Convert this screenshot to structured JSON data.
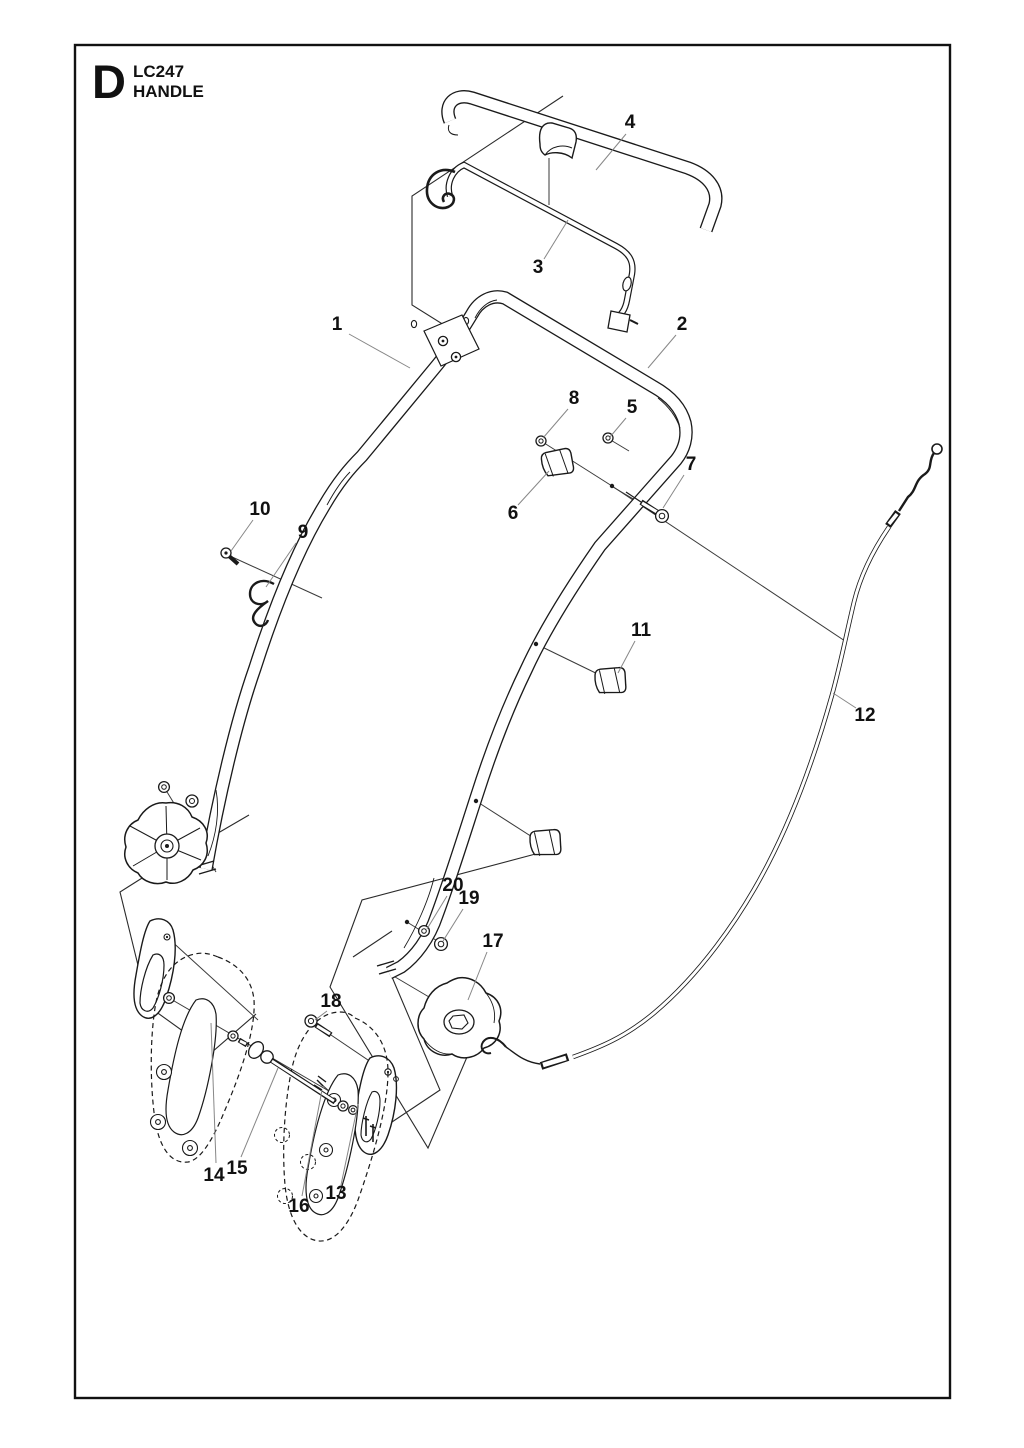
{
  "page": {
    "bg": "#ffffff",
    "ink": "#1a1a1a",
    "leader_color": "#878787",
    "axis_color": "#3a3a3a"
  },
  "title": {
    "section_letter": "D",
    "model": "LC247",
    "sheet_name": "HANDLE"
  },
  "parts_legend": {
    "1": "handle-upper",
    "2": "handle-lower",
    "3": "bail-rod",
    "4": "bail-handle",
    "5": "nut",
    "6": "cable-clamp",
    "7": "bolt",
    "8": "nut",
    "9": "cable-clip",
    "10": "screw",
    "11": "cable-clamp",
    "12": "cable",
    "13": "bracket-plate",
    "14": "handle-bracket-left",
    "15": "carriage-bolt",
    "16": "handle-bracket-right",
    "17": "knob",
    "18": "bolt",
    "19": "nut",
    "20": "washer"
  },
  "callouts": [
    {
      "n": "1",
      "x": 337,
      "y": 330,
      "lx1": 349,
      "ly1": 334,
      "lx2": 410,
      "ly2": 368
    },
    {
      "n": "2",
      "x": 682,
      "y": 330,
      "lx1": 676,
      "ly1": 335,
      "lx2": 648,
      "ly2": 368
    },
    {
      "n": "3",
      "x": 538,
      "y": 273,
      "lx1": 544,
      "ly1": 259,
      "lx2": 568,
      "ly2": 220
    },
    {
      "n": "4",
      "x": 630,
      "y": 128,
      "lx1": 626,
      "ly1": 134,
      "lx2": 596,
      "ly2": 170
    },
    {
      "n": "5",
      "x": 632,
      "y": 413,
      "lx1": 626,
      "ly1": 418,
      "lx2": 610,
      "ly2": 437
    },
    {
      "n": "6",
      "x": 513,
      "y": 519,
      "lx1": 518,
      "ly1": 505,
      "lx2": 549,
      "ly2": 471
    },
    {
      "n": "7",
      "x": 691,
      "y": 470,
      "lx1": 684,
      "ly1": 475,
      "lx2": 663,
      "ly2": 508
    },
    {
      "n": "8",
      "x": 574,
      "y": 404,
      "lx1": 568,
      "ly1": 409,
      "lx2": 543,
      "ly2": 438
    },
    {
      "n": "9",
      "x": 303,
      "y": 538,
      "lx1": 296,
      "ly1": 543,
      "lx2": 266,
      "ly2": 587
    },
    {
      "n": "10",
      "x": 260,
      "y": 515,
      "lx1": 253,
      "ly1": 520,
      "lx2": 231,
      "ly2": 551
    },
    {
      "n": "11",
      "x": 641,
      "y": 636,
      "lx1": 635,
      "ly1": 641,
      "lx2": 618,
      "ly2": 673
    },
    {
      "n": "12",
      "x": 865,
      "y": 721,
      "lx1": 856,
      "ly1": 708,
      "lx2": 833,
      "ly2": 693
    },
    {
      "n": "13",
      "x": 336,
      "y": 1199,
      "lx1": 341,
      "ly1": 1185,
      "lx2": 358,
      "ly2": 1104
    },
    {
      "n": "14",
      "x": 214,
      "y": 1181,
      "lx1": 216,
      "ly1": 1163,
      "lx2": 211,
      "ly2": 1023
    },
    {
      "n": "15",
      "x": 237,
      "y": 1174,
      "lx1": 241,
      "ly1": 1157,
      "lx2": 278,
      "ly2": 1068
    },
    {
      "n": "16",
      "x": 299,
      "y": 1212,
      "lx1": 302,
      "ly1": 1196,
      "lx2": 322,
      "ly2": 1090
    },
    {
      "n": "17",
      "x": 493,
      "y": 947,
      "lx1": 487,
      "ly1": 952,
      "lx2": 468,
      "ly2": 1000
    },
    {
      "n": "18",
      "x": 331,
      "y": 1007,
      "lx1": 327,
      "ly1": 1011,
      "lx2": 315,
      "ly2": 1020
    },
    {
      "n": "19",
      "x": 469,
      "y": 904,
      "lx1": 463,
      "ly1": 909,
      "lx2": 443,
      "ly2": 941
    },
    {
      "n": "20",
      "x": 453,
      "y": 891,
      "lx1": 447,
      "ly1": 896,
      "lx2": 427,
      "ly2": 929
    }
  ]
}
